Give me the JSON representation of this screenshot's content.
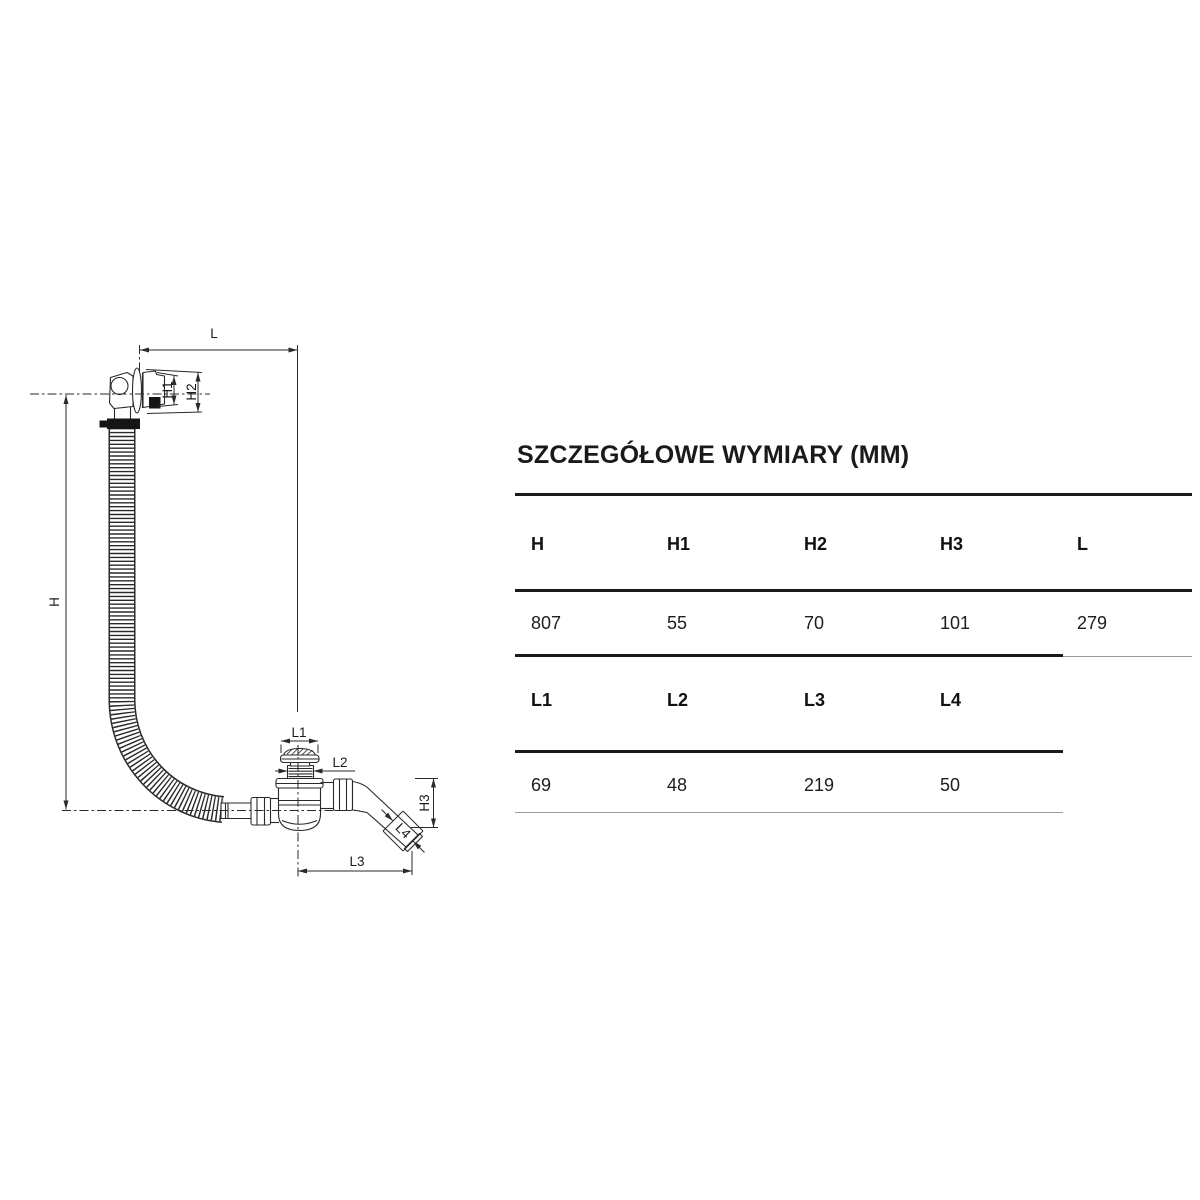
{
  "title": "SZCZEGÓŁOWE WYMIARY (MM)",
  "table": {
    "sections": [
      {
        "headers": [
          "H",
          "H1",
          "H2",
          "H3",
          "L"
        ],
        "values": [
          "807",
          "55",
          "70",
          "101",
          "279"
        ]
      },
      {
        "headers": [
          "L1",
          "L2",
          "L3",
          "L4"
        ],
        "values": [
          "69",
          "48",
          "219",
          "50"
        ]
      }
    ]
  },
  "diagram": {
    "labels": {
      "L": "L",
      "H": "H",
      "H1": "H1",
      "H2": "H2",
      "H3": "H3",
      "L1": "L1",
      "L2": "L2",
      "L3": "L3",
      "L4": "L4"
    }
  },
  "colors": {
    "line": "#2a2a2a",
    "thin_rule": "#9a9a9a",
    "text": "#1a1a1a"
  }
}
